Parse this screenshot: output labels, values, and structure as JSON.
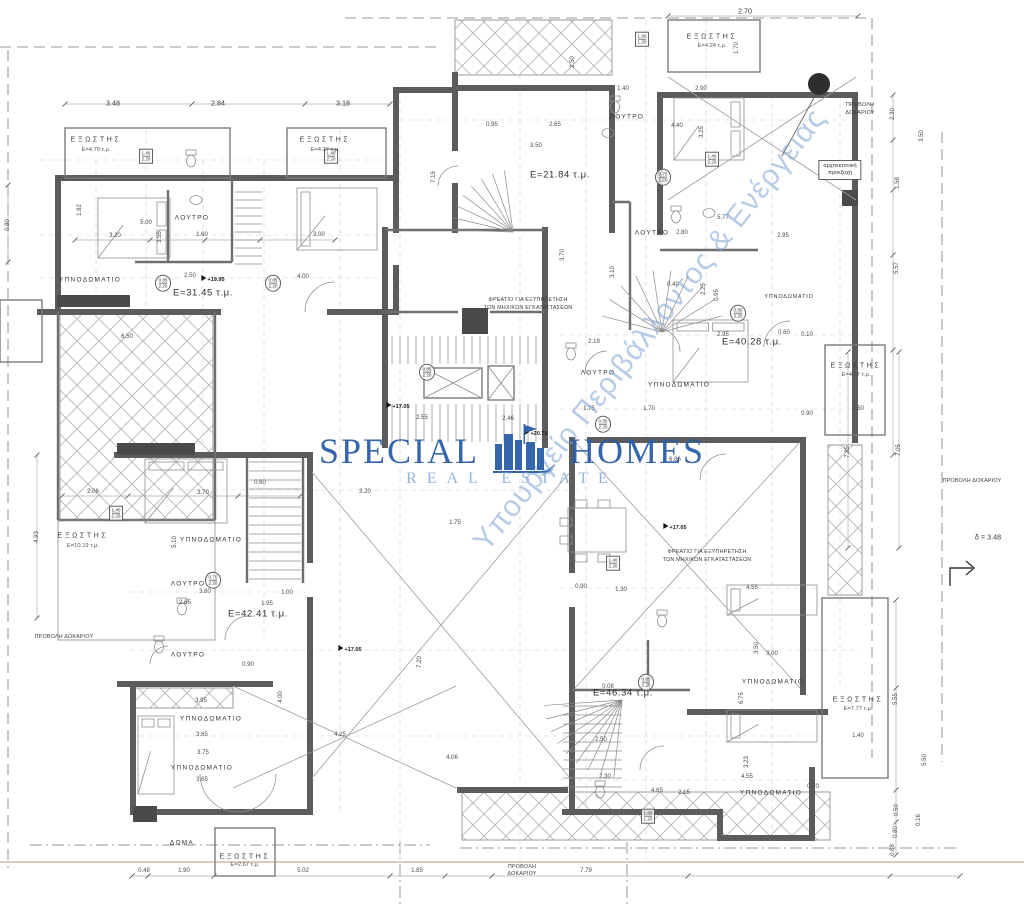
{
  "palette": {
    "wall": "#5c5c5c",
    "ground_line": "#c2907a",
    "marker": "#2e2e2e",
    "brand_color": "#2b5ea8",
    "tagline_color": "#8fb3dc",
    "diagonal_color": "#7fa4d4"
  },
  "watermark": {
    "brand_left": "SPECIAL",
    "brand_right": "HOMES",
    "tagline": "REAL ESTATE",
    "diagonal": "Υπουργείο Περιβάλλοντος & Ενέργειας"
  },
  "labels_format": "text, x, y, class, rotation_deg(optional)",
  "labels": [
    [
      "ΥΠΝΟΔΩΜΑΤΙΟ",
      90,
      280,
      "room"
    ],
    [
      "ΥΠΝΟΔΩΜΑΤΙΟ",
      211,
      540,
      "room"
    ],
    [
      "ΥΠΝΟΔΩΜΑΤΙΟ",
      211,
      719,
      "room"
    ],
    [
      "ΥΠΝΟΔΩΜΑΤΙΟ",
      202,
      768,
      "room"
    ],
    [
      "ΥΠΝΟΔΩΜΑΤΙΟ",
      679,
      385,
      "room"
    ],
    [
      "ΥΠΝΟΔΩΜΑΤΙΟ",
      773,
      682,
      "room"
    ],
    [
      "ΥΠΝΟΔΩΜΑΤΙΟ",
      771,
      793,
      "room"
    ],
    [
      "ΥΠΝΟΔΩΜΑΤΙΟ",
      789,
      297,
      "roomS"
    ],
    [
      "ΛΟΥΤΡΟ",
      192,
      218,
      "room"
    ],
    [
      "ΛΟΥΤΡΟ",
      627,
      117,
      "room"
    ],
    [
      "ΛΟΥΤΡΟ",
      652,
      233,
      "room"
    ],
    [
      "ΛΟΥΤΡΟ",
      598,
      373,
      "room"
    ],
    [
      "ΛΟΥΤΡΟ",
      188,
      584,
      "room"
    ],
    [
      "ΛΟΥΤΡΟ",
      188,
      655,
      "room"
    ],
    [
      "ΔΩΜΑ",
      182,
      843,
      "room"
    ],
    [
      "ΕΞΩΣΤΗΣ",
      96,
      140,
      "balc"
    ],
    [
      "Ε=4.79 τ.μ.",
      96,
      150,
      "balca"
    ],
    [
      "ΕΞΩΣΤΗΣ",
      325,
      140,
      "balc"
    ],
    [
      "Ε=4.37 τ.μ.",
      325,
      150,
      "balca"
    ],
    [
      "ΕΞΩΣΤΗΣ",
      712,
      37,
      "balc"
    ],
    [
      "Ε=4.24 τ.μ.",
      712,
      46,
      "balca"
    ],
    [
      "ΕΞΩΣΤΗΣ",
      856,
      366,
      "balc"
    ],
    [
      "Ε=4.27 τ.μ.",
      856,
      375,
      "balca"
    ],
    [
      "ΕΞΩΣΤΗΣ",
      83,
      536,
      "balc"
    ],
    [
      "Ε=10.19 τ.μ.",
      83,
      546,
      "balca"
    ],
    [
      "ΕΞΩΣΤΗΣ",
      858,
      700,
      "balc"
    ],
    [
      "Ε=7.77 τ.μ.",
      858,
      709,
      "balca"
    ],
    [
      "ΕΞΩΣΤΗΣ",
      245,
      857,
      "balc"
    ],
    [
      "Ε=2.67 τ.μ.",
      245,
      865,
      "balca"
    ],
    [
      "Ε=31.45 τ.μ.",
      203,
      293,
      "area"
    ],
    [
      "Ε=21.84 τ.μ.",
      560,
      175,
      "area"
    ],
    [
      "Ε=40.28 τ.μ.",
      752,
      342,
      "area"
    ],
    [
      "Ε=42.41 τ.μ.",
      258,
      614,
      "area"
    ],
    [
      "Ε=46.34 τ.μ.",
      623,
      693,
      "area"
    ],
    [
      "ΦΡΕΑΤΙΟ ΓΙΑ ΕΞΥΠΗΡΕΤΗΣΗ",
      528,
      300,
      "note"
    ],
    [
      "ΤΩΝ ΜΗΧ/ΚΩΝ ΕΓΚΑΤΑΣΤΑΣΕΩΝ",
      528,
      308,
      "note"
    ],
    [
      "ΦΡΕΑΤΙΟ ΓΙΑ ΕΞΥΠΗΡΕΤΗΣΗ",
      707,
      552,
      "note"
    ],
    [
      "ΤΩΝ ΜΗΧ/ΚΩΝ ΕΓΚΑΤΑΣΤΑΣΕΩΝ",
      707,
      560,
      "note"
    ],
    [
      "ΠΡΟΒΟΛΗ",
      860,
      105,
      "note"
    ],
    [
      "ΔΟΚΑΡΙΟΥ",
      860,
      113,
      "note"
    ],
    [
      "ΠΡΟΒΟΛΗ ΔΟΚΑΡΙΟΥ",
      64,
      637,
      "note"
    ],
    [
      "ΠΡΟΒΟΛΗ ΔΟΚΑΡΙΟΥ",
      972,
      481,
      "note"
    ],
    [
      "ΠΡΟΒΟΛΗ",
      522,
      867,
      "note"
    ],
    [
      "ΔΟΚΑΡΙΟΥ",
      522,
      874,
      "note"
    ],
    [
      "δ = 3.48",
      988,
      537,
      "dimL"
    ],
    [
      "+17.05",
      398,
      406,
      "level"
    ],
    [
      "+20.70",
      536,
      433,
      "level"
    ],
    [
      "+19.95",
      213,
      279,
      "level"
    ],
    [
      "+17.05",
      350,
      649,
      "level"
    ],
    [
      "+17.05",
      675,
      527,
      "level"
    ],
    [
      "3.48",
      113,
      103,
      "dimL"
    ],
    [
      "2.84",
      218,
      103,
      "dimL"
    ],
    [
      "3.18",
      343,
      103,
      "dimL"
    ],
    [
      "2.70",
      745,
      11,
      "dimL"
    ],
    [
      "1.40",
      623,
      89,
      "dim"
    ],
    [
      "2.90",
      701,
      89,
      "dim"
    ],
    [
      "0.95",
      492,
      125,
      "dim"
    ],
    [
      "2.65",
      555,
      125,
      "dim"
    ],
    [
      "3.50",
      536,
      146,
      "dim"
    ],
    [
      "4.40",
      677,
      126,
      "dim"
    ],
    [
      "2.80",
      682,
      233,
      "dim"
    ],
    [
      "5.77",
      723,
      218,
      "dim"
    ],
    [
      "3.20",
      115,
      236,
      "dim"
    ],
    [
      "5.00",
      146,
      223,
      "dim"
    ],
    [
      "1.60",
      202,
      235,
      "dim"
    ],
    [
      "3.00",
      319,
      235,
      "dim"
    ],
    [
      "2.50",
      190,
      276,
      "dim"
    ],
    [
      "4.00",
      303,
      277,
      "dim"
    ],
    [
      "6.50",
      127,
      337,
      "dim"
    ],
    [
      "2.06",
      93,
      492,
      "dim"
    ],
    [
      "3.70",
      203,
      493,
      "dim"
    ],
    [
      "0.60",
      260,
      483,
      "dim"
    ],
    [
      "3.80",
      205,
      592,
      "dim"
    ],
    [
      "1.00",
      287,
      593,
      "dim"
    ],
    [
      "1.95",
      267,
      604,
      "dim"
    ],
    [
      "2.65",
      185,
      603,
      "dim"
    ],
    [
      "0.90",
      248,
      665,
      "dim"
    ],
    [
      "3.95",
      201,
      701,
      "dim"
    ],
    [
      "3.65",
      202,
      735,
      "dim"
    ],
    [
      "3.75",
      203,
      753,
      "dim"
    ],
    [
      "3.65",
      202,
      780,
      "dim"
    ],
    [
      "4.25",
      340,
      735,
      "dim"
    ],
    [
      "4.06",
      452,
      758,
      "dim"
    ],
    [
      "2.55",
      422,
      418,
      "dim"
    ],
    [
      "2.46",
      508,
      419,
      "dim"
    ],
    [
      "3.20",
      365,
      492,
      "dim"
    ],
    [
      "1.75",
      455,
      523,
      "dim"
    ],
    [
      "1.75",
      589,
      409,
      "dim"
    ],
    [
      "1.70",
      649,
      409,
      "dim"
    ],
    [
      "6.86",
      675,
      460,
      "dim"
    ],
    [
      "2.19",
      594,
      342,
      "dim"
    ],
    [
      "2.95",
      723,
      335,
      "dim"
    ],
    [
      "2.95",
      783,
      236,
      "dim"
    ],
    [
      "0.60",
      784,
      333,
      "dim"
    ],
    [
      "0.10",
      807,
      335,
      "dim"
    ],
    [
      "0.90",
      807,
      414,
      "dim"
    ],
    [
      "1.50",
      858,
      409,
      "dim"
    ],
    [
      "0.40",
      673,
      285,
      "dim"
    ],
    [
      "4.55",
      752,
      588,
      "dim"
    ],
    [
      "1.30",
      621,
      590,
      "dim"
    ],
    [
      "0.90",
      581,
      587,
      "dim"
    ],
    [
      "2.50",
      601,
      740,
      "dim"
    ],
    [
      "3.00",
      772,
      654,
      "dim"
    ],
    [
      "4.55",
      747,
      777,
      "dim"
    ],
    [
      "0.70",
      813,
      787,
      "dim"
    ],
    [
      "1.40",
      858,
      736,
      "dim"
    ],
    [
      "2.30",
      605,
      777,
      "dim"
    ],
    [
      "4.65",
      657,
      791,
      "dim"
    ],
    [
      "2.15",
      684,
      793,
      "dim"
    ],
    [
      "0.08",
      608,
      687,
      "dim"
    ],
    [
      "0.48",
      144,
      871,
      "dim"
    ],
    [
      "1.90",
      184,
      871,
      "dim"
    ],
    [
      "5.02",
      303,
      871,
      "dim"
    ],
    [
      "1.85",
      417,
      871,
      "dim"
    ],
    [
      "7.79",
      586,
      871,
      "dim"
    ],
    [
      "0.80",
      8,
      225,
      "dim",
      -90
    ],
    [
      "1.82",
      80,
      210,
      "dim",
      -90
    ],
    [
      "3.55",
      160,
      237,
      "dim",
      -90
    ],
    [
      "4.93",
      37,
      537,
      "dim",
      -90
    ],
    [
      "5.10",
      175,
      542,
      "dim",
      -90
    ],
    [
      "7.15",
      434,
      177,
      "dim",
      -90
    ],
    [
      "2.50",
      573,
      62,
      "dim",
      -90
    ],
    [
      "1.70",
      737,
      48,
      "dim",
      -90
    ],
    [
      "3.25",
      702,
      132,
      "dim",
      -90
    ],
    [
      "2.25",
      704,
      289,
      "dim",
      -90
    ],
    [
      "0.95",
      717,
      295,
      "dim",
      -90
    ],
    [
      "3.10",
      613,
      272,
      "dim",
      -90
    ],
    [
      "3.70",
      563,
      255,
      "dim",
      -90
    ],
    [
      "2.30",
      893,
      114,
      "dim",
      -90
    ],
    [
      "3.50",
      922,
      136,
      "dim",
      -90
    ],
    [
      "1.58",
      898,
      183,
      "dim",
      -90
    ],
    [
      "5.57",
      897,
      268,
      "dim",
      -90
    ],
    [
      "7.05",
      899,
      450,
      "dim",
      -90
    ],
    [
      "7.85",
      848,
      452,
      "dim",
      -90
    ],
    [
      "5.55",
      896,
      699,
      "dim",
      -90
    ],
    [
      "0.50",
      897,
      810,
      "dim",
      -90
    ],
    [
      "0.80",
      896,
      832,
      "dim",
      -90
    ],
    [
      "0.16",
      919,
      820,
      "dim",
      -90
    ],
    [
      "5.50",
      925,
      760,
      "dim",
      -90
    ],
    [
      "0.88",
      893,
      850,
      "dim",
      -90
    ],
    [
      "6.75",
      742,
      698,
      "dim",
      -90
    ],
    [
      "3.23",
      747,
      762,
      "dim",
      -90
    ],
    [
      "3.50",
      757,
      648,
      "dim",
      -90
    ],
    [
      "4.00",
      281,
      697,
      "dim",
      -90
    ],
    [
      "7.20",
      420,
      662,
      "dim",
      -90
    ]
  ],
  "tags_format": "x, y, line1, line2, shape(rect|oval|box)",
  "tags": [
    [
      146,
      156,
      "1.40",
      "2.20",
      "rect"
    ],
    [
      331,
      156,
      "1.40",
      "2.20",
      "rect"
    ],
    [
      712,
      159,
      "1.40",
      "2.20",
      "rect"
    ],
    [
      642,
      39,
      "1.60",
      "1.20",
      "rect"
    ],
    [
      116,
      513,
      "1.40",
      "2.20",
      "rect"
    ],
    [
      648,
      816,
      "1.60",
      "1.20",
      "rect"
    ],
    [
      613,
      563,
      "1.40",
      "2.20",
      "rect"
    ],
    [
      163,
      283,
      "0.85",
      "2.20",
      "oval"
    ],
    [
      273,
      283,
      "0.85",
      "2.20",
      "oval"
    ],
    [
      663,
      177,
      "0.75",
      "2.20",
      "oval"
    ],
    [
      738,
      313,
      "0.85",
      "2.20",
      "oval"
    ],
    [
      646,
      682,
      "0.85",
      "2.20",
      "oval"
    ],
    [
      603,
      424,
      "0.85",
      "2.20",
      "oval"
    ],
    [
      213,
      580,
      "0.75",
      "2.20",
      "oval"
    ],
    [
      427,
      372,
      "0.85",
      "2.20",
      "oval"
    ],
    [
      840,
      170,
      "αρχιτεκτονική",
      "προεξοχή",
      "box"
    ]
  ]
}
